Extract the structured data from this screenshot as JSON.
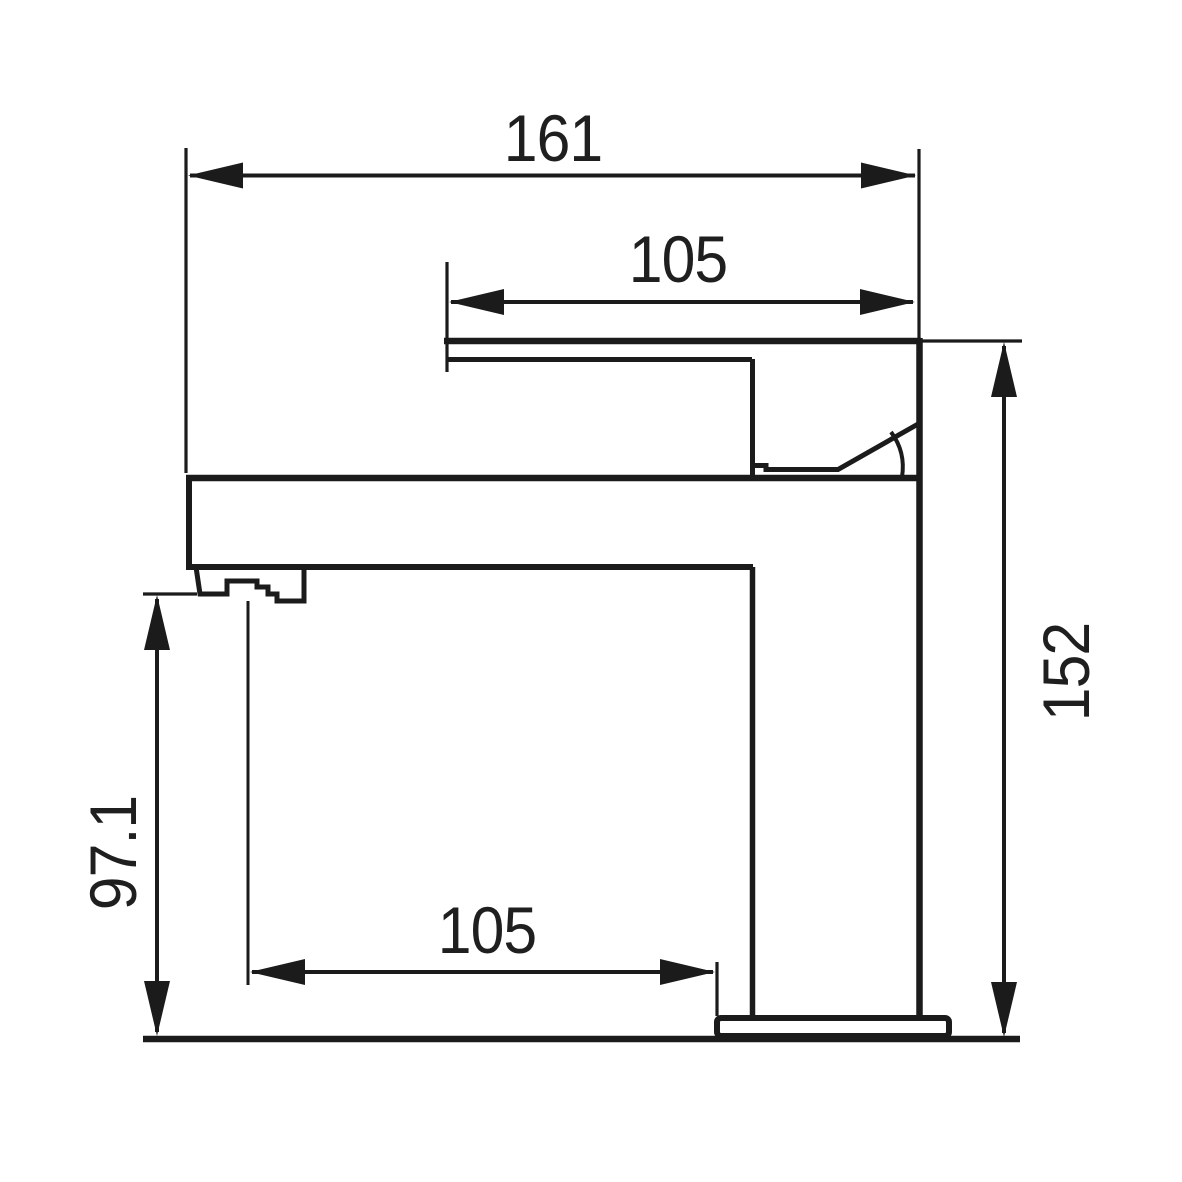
{
  "drawing": {
    "title": "Single-lever basin mixer faucet, side elevation",
    "background_color": "#ffffff",
    "line_color": "#1b1b1b",
    "text_color": "#1f1f1f",
    "dimensions": {
      "overall_width": {
        "value": "161",
        "orientation": "horizontal",
        "location": "top"
      },
      "handle_reach": {
        "value": "105",
        "orientation": "horizontal",
        "location": "upper"
      },
      "overall_height": {
        "value": "152",
        "orientation": "vertical",
        "location": "right"
      },
      "spout_outlet_height": {
        "value": "97.1",
        "orientation": "vertical",
        "location": "left"
      },
      "spout_reach": {
        "value": "105",
        "orientation": "horizontal",
        "location": "bottom"
      }
    }
  }
}
